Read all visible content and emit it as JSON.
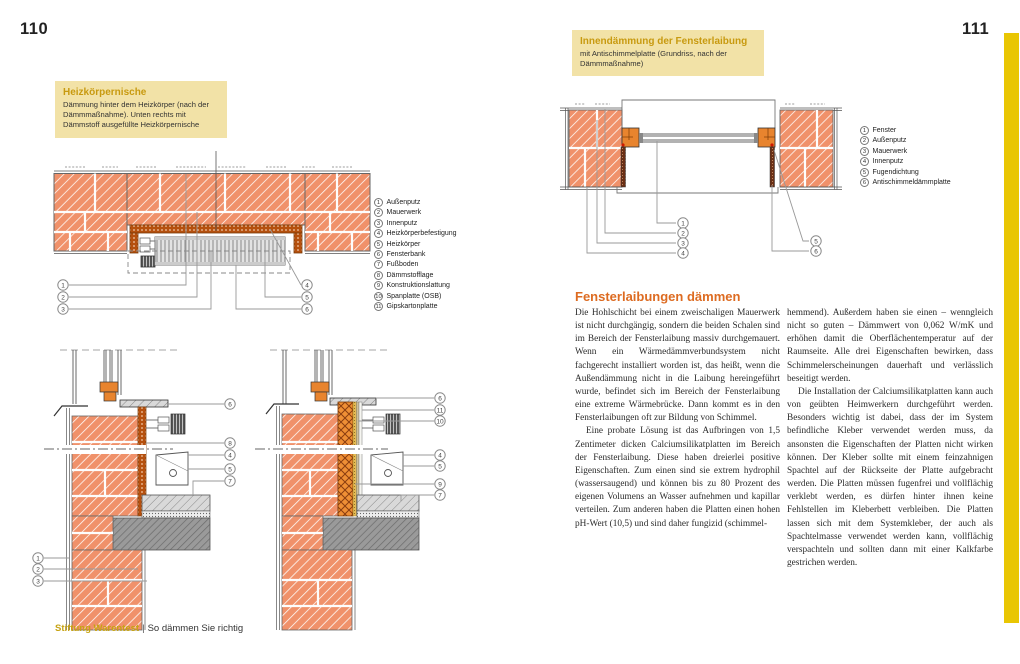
{
  "callouts": {
    "n1": "1",
    "n2": "2",
    "n3": "3",
    "n4": "4",
    "n5": "5",
    "n6": "6",
    "n7": "7",
    "n8": "8",
    "n9": "9",
    "n10": "10",
    "n11": "11"
  },
  "left_page": {
    "page_number": "110",
    "info_box": {
      "title": "Heizkörpernische",
      "body": "Dämmung hinter dem Heizkörper (nach der Dämmmaßnahme). Unten rechts mit Dämmstoff ausgefüllte Heizkörpernische"
    },
    "legend_items": [
      {
        "num": "1",
        "label": "Außenputz"
      },
      {
        "num": "2",
        "label": "Mauerwerk"
      },
      {
        "num": "3",
        "label": "Innenputz"
      },
      {
        "num": "4",
        "label": "Heizkörperbefestigung"
      },
      {
        "num": "5",
        "label": "Heizkörper"
      },
      {
        "num": "6",
        "label": "Fensterbank"
      },
      {
        "num": "7",
        "label": "Fußboden"
      },
      {
        "num": "8",
        "label": "Dämmstofflage"
      },
      {
        "num": "9",
        "label": "Konstruktionslattung"
      },
      {
        "num": "10",
        "label": "Spanplatte (OSB)"
      },
      {
        "num": "11",
        "label": "Gipskartonplatte"
      }
    ],
    "footer": {
      "publisher": "Stiftung Warentest",
      "separator": "|",
      "book_title": "So dämmen Sie richtig"
    }
  },
  "right_page": {
    "page_number": "111",
    "info_box": {
      "title": "Innendämmung der Fensterlaibung",
      "body": "mit Antischimmelplatte (Grundriss, nach der Dämmmaßnahme)"
    },
    "legend_items": [
      {
        "num": "1",
        "label": "Fenster"
      },
      {
        "num": "2",
        "label": "Außenputz"
      },
      {
        "num": "3",
        "label": "Mauerwerk"
      },
      {
        "num": "4",
        "label": "Innenputz"
      },
      {
        "num": "5",
        "label": "Fugendichtung"
      },
      {
        "num": "6",
        "label": "Antischimmeldämmplatte"
      }
    ],
    "article": {
      "heading": "Fensterlaibungen dämmen",
      "col1_par1": "Die Hohlschicht bei einem zweischaligen Mauerwerk ist nicht durchgängig, sondern die beiden Schalen sind im Bereich der Fensterlaibung massiv durchgemauert. Wenn ein Wärmedämmverbundsystem nicht fachgerecht installiert worden ist, das heißt, wenn die Außendämmung nicht in die Laibung hereingeführt wurde, befindet sich im Bereich der Fensterlaibung eine extreme Wärmebrücke. Dann kommt es in den Fensterlaibungen oft zur Bildung von Schimmel.",
      "col1_par2": "Eine probate Lösung ist das Aufbringen von 1,5 Zentimeter dicken Calciumsilikatplatten im Bereich der Fensterlaibung. Diese haben dreierlei positive Eigenschaften. Zum einen sind sie extrem hydrophil (wassersaugend) und können bis zu 80 Prozent des eigenen Volumens an Wasser aufnehmen und kapillar verteilen. Zum anderen haben die Platten einen hohen pH-Wert (10,5) und sind daher fungizid (schimmel-",
      "col2_par1": "hemmend). Außerdem haben sie einen – wenngleich nicht so guten – Dämmwert von 0,062 W/mK und erhöhen damit die Oberflächentemperatur auf der Raumseite. Alle drei Eigenschaften bewirken, dass Schimmelerscheinungen dauerhaft und verlässlich beseitigt werden.",
      "col2_par2": "Die Installation der Calciumsilikatplatten kann auch von geübten Heimwerkern durchgeführt werden. Besonders wichtig ist dabei, dass der im System befindliche Kleber verwendet werden muss, da ansonsten die Eigenschaften der Platten nicht wirken können. Der Kleber sollte mit einem feinzahnigen Spachtel auf der Rückseite der Platte aufgebracht werden. Die Platten müssen fugenfrei und vollflächig verklebt werden, es dürfen hinter ihnen keine Fehlstellen im Kleberbett verbleiben. Die Platten lassen sich mit dem Systemkleber, der auch als Spachtelmasse verwendet werden kann, vollflächig verspachteln und sollten dann mit einer Kalkfarbe gestrichen werden."
    }
  },
  "colors": {
    "accent_gold": "#c7a313",
    "heading_orange": "#dd6b21",
    "info_box_bg": "#f2e2a7",
    "tab_yellow": "#e9c603",
    "brick": "#f0916a"
  }
}
